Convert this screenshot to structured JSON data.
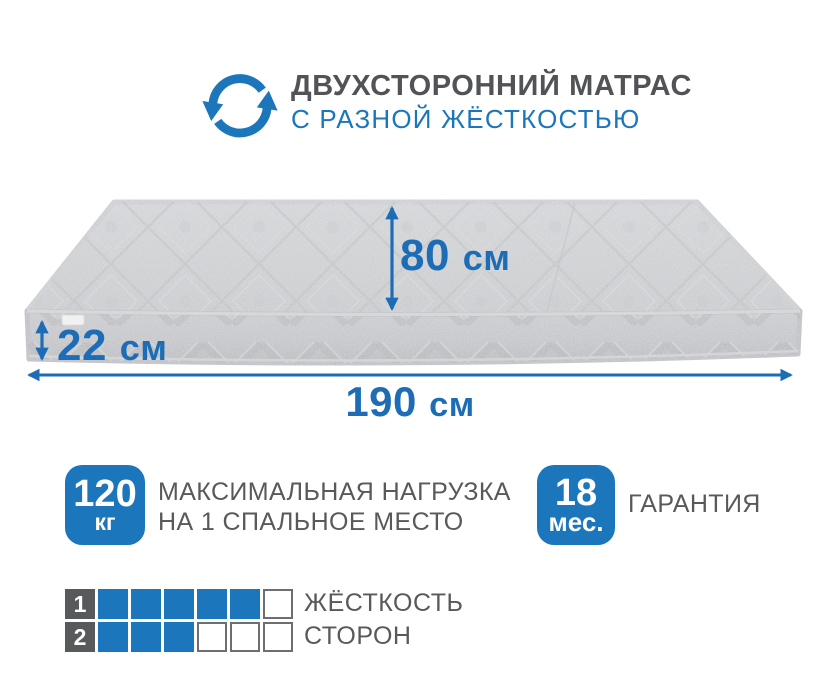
{
  "header": {
    "icon": "rotate-arrows",
    "title_line1": "ДВУХСТОРОННИЙ МАТРАС",
    "title_line2": "С РАЗНОЙ ЖЁСТКОСТЬЮ"
  },
  "mattress": {
    "width_label": "80",
    "height_label": "22",
    "length_label": "190",
    "unit": "см"
  },
  "features": {
    "max_load": {
      "value": "120",
      "unit": "кг",
      "label_line1": "МАКСИМАЛЬНАЯ НАГРУЗКА",
      "label_line2": "НА 1 СПАЛЬНОЕ МЕСТО"
    },
    "warranty": {
      "value": "18",
      "unit": "мес.",
      "label": "ГАРАНТИЯ"
    }
  },
  "firmness": {
    "label_line1": "ЖЁСТКОСТЬ",
    "label_line2": "СТОРОН",
    "scale_max": 6,
    "rows": [
      {
        "side": "1",
        "filled": 5
      },
      {
        "side": "2",
        "filled": 3
      }
    ]
  },
  "colors": {
    "accent_blue": "#1b76bc",
    "dimension_blue": "#1c6db6",
    "text_gray": "#58595b",
    "title_gray": "#525357",
    "mattress_top": "#c7c9cc",
    "mattress_side": "#b8babd"
  }
}
